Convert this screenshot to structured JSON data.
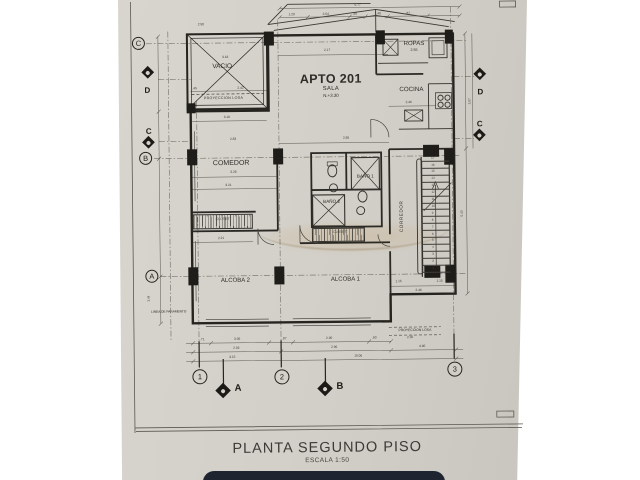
{
  "title": {
    "main": "PLANTA SEGUNDO PISO",
    "scale": "ESCALA 1:50"
  },
  "apartment": {
    "name": "APTO 201",
    "room": "SALA",
    "level": "N.+3.30"
  },
  "rooms": {
    "vacio": "VACIO",
    "ropas": "ROPAS",
    "cocina": "COCINA",
    "comedor": "COMEDOR",
    "bano1": "BAÑO 1",
    "bano2": "BAÑO 2",
    "corredor": "CORREDOR",
    "closet1": "CLOSET",
    "closet2": "CLOSET",
    "alcoba1": "ALCOBA 1",
    "alcoba2": "ALCOBA 2"
  },
  "annotations": {
    "proyeccion_losa_top": "PROYECCION  LOSA",
    "proyeccion_losa_bottom": "PROYECCION  LOSA",
    "linea_paramento": "LINEA DE PARAMENTO",
    "ropas_dim": "2.55"
  },
  "grid": {
    "left_circles": [
      "C",
      "B",
      "A"
    ],
    "left_sections": [
      "D",
      "C"
    ],
    "right_sections": [
      "D",
      "C"
    ],
    "bottom": [
      "1",
      "2",
      "3"
    ],
    "bottom_sections": [
      "A",
      "B"
    ]
  },
  "dims": [
    "6.77",
    "1.20",
    "2.64",
    ".80",
    "1.48",
    ".87",
    "2.17",
    "2.58",
    "3.18",
    ".45",
    "2.42",
    "3.18",
    "2.83",
    "2.85",
    "2.46",
    "3.28",
    "3.21",
    "2.21",
    "1.15",
    "1.15",
    "2.46",
    ".71",
    "3.05",
    ".87",
    "2.90",
    ".60",
    "2.93",
    "2.96",
    "3.15",
    "10.06",
    "5.43",
    "3.07",
    "1.44",
    "2.02",
    "4.90"
  ],
  "stairs": {
    "numbers": [
      "1",
      "2",
      "3",
      "4",
      "5",
      "6",
      "7",
      "8",
      "9",
      "10",
      "11",
      "12",
      "13",
      "14",
      "15",
      "16",
      "17"
    ]
  },
  "colors": {
    "paper": "#d2cfc8",
    "ink": "#26241f",
    "watermark": "#c08a3e",
    "phone_edge": "#1e2530"
  }
}
